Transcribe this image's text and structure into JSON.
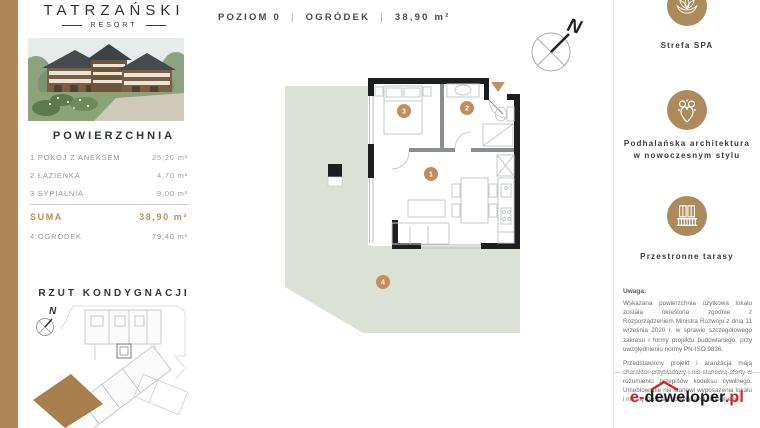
{
  "brand": {
    "name": "TATRZAŃSKI",
    "subtitle": "RESORT"
  },
  "left_panel": {
    "area_section": {
      "title": "POWIERZCHNIA",
      "rooms": [
        {
          "label": "1 POKÓJ Z ANEKSEM",
          "value": "25,20 m²"
        },
        {
          "label": "2 ŁAZIENKA",
          "value": "4,70 m²"
        },
        {
          "label": "3 SYPIALNIA",
          "value": "9,00 m²"
        }
      ],
      "total": {
        "label": "SUMA",
        "value": "38,90 m²"
      },
      "garden": {
        "label": "4 OGRÓDEK",
        "value": "79,40 m²"
      }
    },
    "floor_overview_title": "RZUT KONDYGNACJI",
    "compass_label": "N"
  },
  "plan": {
    "header": {
      "level": "POZIOM 0",
      "separator": "|",
      "feature": "OGRÓDEK",
      "area": "38,90 m²"
    },
    "compass_label": "N",
    "badges": {
      "living": "1",
      "bathroom": "2",
      "bedroom": "3",
      "garden": "4"
    }
  },
  "right_panel": {
    "features": [
      {
        "icon": "lotus-spa-icon",
        "label_line1": "Strefa SPA",
        "label_line2": ""
      },
      {
        "icon": "highlander-ornament-icon",
        "label_line1": "Podhalańska architektura",
        "label_line2": "w nowoczesnym stylu"
      },
      {
        "icon": "balcony-terrace-icon",
        "label_line1": "Przestronne tarasy",
        "label_line2": ""
      }
    ],
    "note": {
      "title": "Uwaga:",
      "paragraphs": [
        "Wskazana powierzchnia użytkowa lokalu została określona zgodnie z Rozporządzeniem Ministra Rozwoju z dnia 11 września 2020 r. w sprawie szczegółowego zakresu i formy projektu budowlanego, przy uwzględnieniu normy PN-ISO 9836.",
        "Przedstawiony projekt i aranżacja mają charakter przykładowy i nie stanowią oferty w rozumieniu przepisów kodeksu cywilnego. Umeblowanie nie stanowi wyposażenia lokalu i nie są częścią zobowiązania umownego."
      ]
    },
    "logo": {
      "prefix": "e-",
      "middle": "deweloper",
      "suffix": ".pl"
    }
  },
  "colors": {
    "accent_gold": "#ae8657",
    "badge_tan": "#c58d5b",
    "garden_green": "#dbe1d4",
    "logo_red": "#d2232a"
  }
}
